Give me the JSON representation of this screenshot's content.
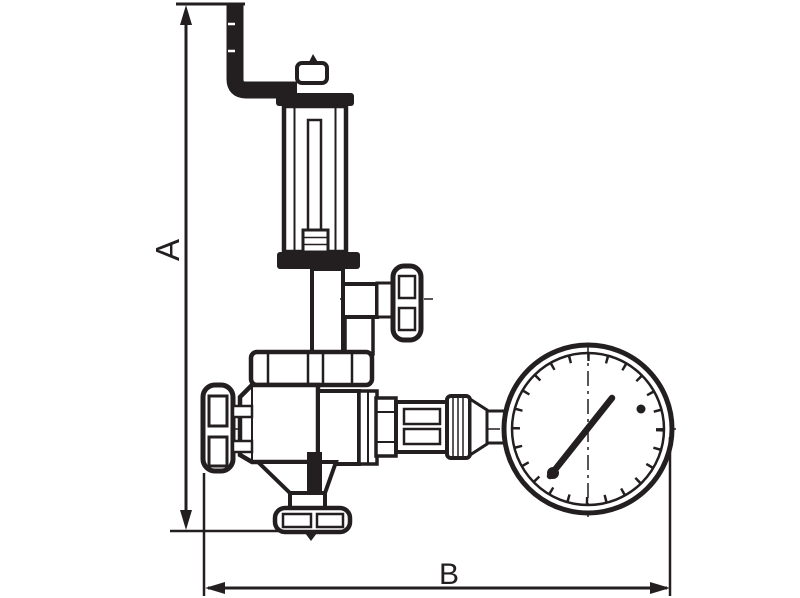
{
  "diagram": {
    "subject": "spring safety valve with vent elbow pipe and pressure gauge, dimensioned outline drawing",
    "dimension_labels": {
      "vertical": "A",
      "horizontal": "B"
    },
    "colors": {
      "line": "#231f20",
      "background": "#ffffff"
    },
    "gauge": {
      "needle_direction": "upper-right",
      "max_marker": "small dot at right of dial"
    }
  }
}
